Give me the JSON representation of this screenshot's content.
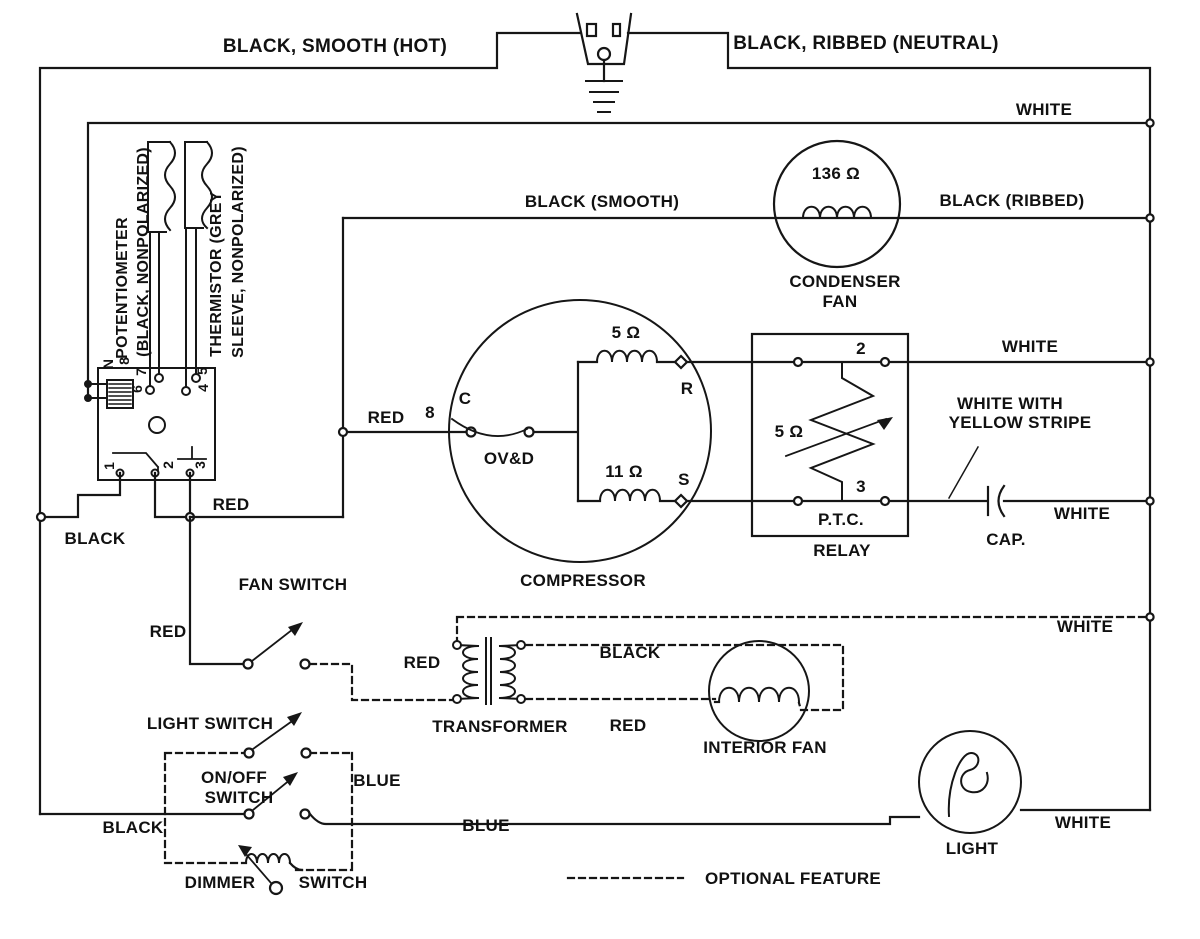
{
  "wires": {
    "hot": "BLACK, SMOOTH (HOT)",
    "neutral": "BLACK, RIBBED (NEUTRAL)",
    "white_top": "WHITE",
    "black_smooth": "BLACK (SMOOTH)",
    "black_ribbed": "BLACK (RIBBED)",
    "white_relay": "WHITE",
    "white_yellow_line1": "WHITE WITH",
    "white_yellow_line2": "YELLOW STRIPE",
    "white_cap": "WHITE",
    "white_transformer": "WHITE",
    "white_light": "WHITE",
    "red_board": "RED",
    "red_fan_switch": "RED",
    "red_compressor": "RED",
    "wire_number_8": "8",
    "red_primary": "RED",
    "red_secondary": "RED",
    "black_board": "BLACK",
    "black_bottom": "BLACK",
    "black_secondary": "BLACK",
    "blue_vertical": "BLUE",
    "blue_bottom": "BLUE"
  },
  "board": {
    "pot_label_line1": "POTENTIOMETER",
    "pot_label_line2": "(BLACK, NONPOLARIZED)",
    "thermistor_label_line1": "THERMISTOR (GREY",
    "thermistor_label_line2": "SLEEVE, NONPOLARIZED)",
    "t_top": [
      "N",
      "8",
      "7",
      "6",
      "5",
      "4"
    ],
    "t_bottom": [
      "1",
      "2",
      "3"
    ]
  },
  "compressor": {
    "name": "COMPRESSOR",
    "terminal_c": "C",
    "overload": "OV&D",
    "terminal_r": "R",
    "terminal_s": "S",
    "run_winding": "5 Ω",
    "start_winding": "11 Ω"
  },
  "relay": {
    "name_line1": "P.T.C.",
    "name_line2": "RELAY",
    "terminal_2": "2",
    "terminal_3": "3",
    "resistance": "5 Ω"
  },
  "condenser_fan": {
    "name_line1": "CONDENSER",
    "name_line2": "FAN",
    "resistance": "136 Ω"
  },
  "capacitor": {
    "name": "CAP."
  },
  "transformer": {
    "name": "TRANSFORMER"
  },
  "interior_fan": {
    "name": "INTERIOR FAN"
  },
  "light": {
    "name": "LIGHT"
  },
  "switches": {
    "fan": "FAN SWITCH",
    "light": "LIGHT SWITCH",
    "onoff_line1": "ON/OFF",
    "onoff_line2": "SWITCH",
    "dimmer_line1": "DIMMER",
    "dimmer_line2": "SWITCH"
  },
  "legend": {
    "optional": "OPTIONAL FEATURE"
  }
}
